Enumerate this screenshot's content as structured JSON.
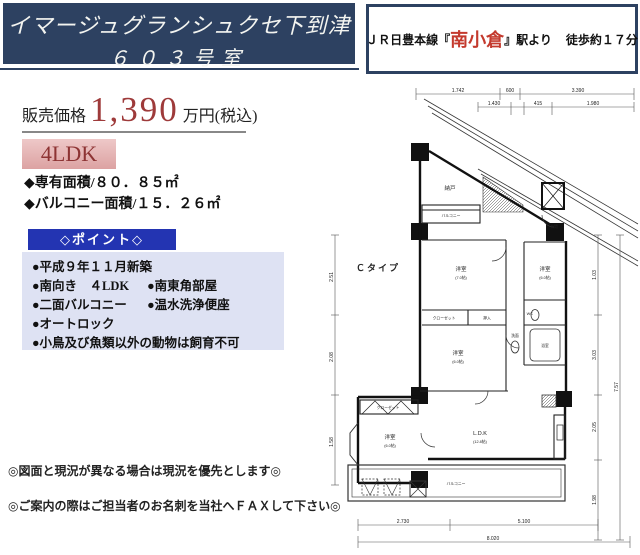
{
  "title": {
    "building": "イマージュグランシュクセ下到津",
    "room": "６０３号室"
  },
  "station": {
    "prefix": "ＪＲ日豊本線『",
    "name": "南小倉",
    "suffix": "』駅より",
    "walk": "徒歩約１７分"
  },
  "price": {
    "label": "販売価格",
    "amount": "1,390",
    "unit": "万円(税込)"
  },
  "layout_badge": "4LDK",
  "areas": {
    "exclusive": "◆専有面積/８０．８５㎡",
    "balcony": "◆バルコニー面積/１５．２６㎡"
  },
  "points": {
    "title": "◇ポイント◇",
    "rows": [
      {
        "left": "●平成９年１１月新築",
        "right": ""
      },
      {
        "left": "●南向き　４LDK",
        "right": "●南東角部屋"
      },
      {
        "left": "●二面バルコニー",
        "right": "●温水洗浄便座"
      },
      {
        "left": "●オートロック",
        "right": ""
      },
      {
        "left": "●小鳥及び魚類以外の動物は飼育不可",
        "right": ""
      }
    ]
  },
  "notes": {
    "note1": "◎図面と現況が異なる場合は現況を優先とします◎",
    "note2": "◎ご案内の際はご担当者のお名刺を当社へＦＡＸして下さい◎"
  },
  "floorplan": {
    "type_label": "Ｃタイプ",
    "labels": {
      "nando": "納戸",
      "balcony_top": "バルコニー",
      "room1": "洋室",
      "room1_size": "(7.0帖)",
      "closet1": "クローゼット",
      "oshiire": "押入",
      "room2": "洋室",
      "room2_size": "(6.0帖)",
      "room3": "洋室",
      "room3_size": "(6.0帖)",
      "closet2": "クローゼット",
      "ldk": "L.D.K",
      "ldk_size": "(12.8帖)",
      "bath": "浴室",
      "wc": "WC",
      "senmen": "洗面",
      "genkan": "玄関",
      "balcony_bottom": "バルコニー"
    },
    "dims": {
      "top": [
        "1.742",
        "600",
        "3.390"
      ],
      "top2": [
        "1.430",
        "415",
        "1.980"
      ],
      "bottom": [
        "2.730",
        "5.100"
      ],
      "bottom_total": "8.020",
      "left": [
        "2.51",
        "2.08",
        "1.58"
      ],
      "right": [
        "1.03",
        "3.03",
        "2.05",
        "1.98"
      ],
      "right_total": "7.57"
    }
  },
  "colors": {
    "navy": "#2d4161",
    "station-red": "#c43a2e",
    "price-red": "#9e3a3a",
    "badge-bg1": "#eec8c8",
    "badge-bg2": "#dca2a2",
    "badge-text": "#8d3333",
    "points-blue": "#2334b2",
    "points-bg": "#dee2f3"
  }
}
